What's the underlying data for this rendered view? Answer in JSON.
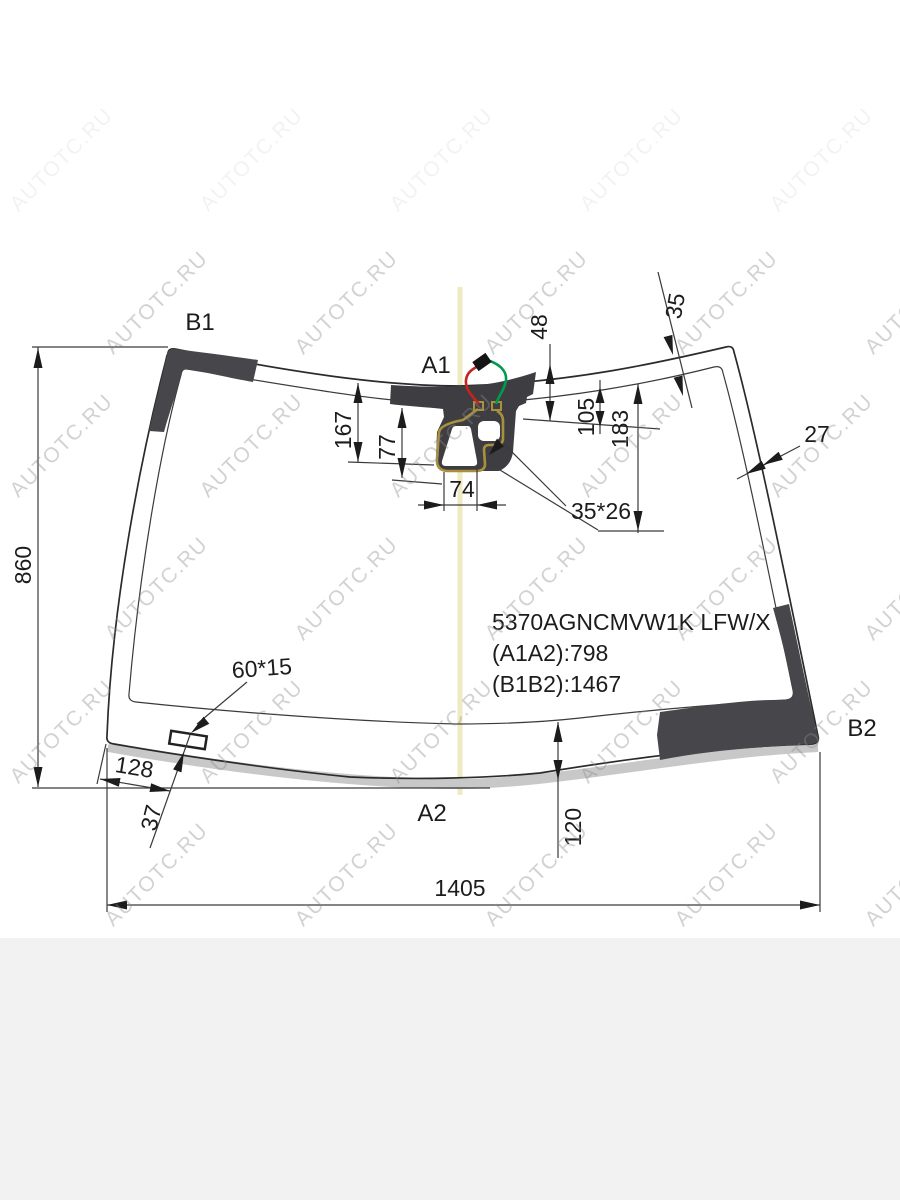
{
  "product": {
    "code": "5370AGNCMVW1K LFW/X",
    "a1a2": "(A1A2):798",
    "b1b2": "(B1B2):1467"
  },
  "labels": {
    "b1": "B1",
    "a1": "A1",
    "a2": "A2",
    "b2": "B2"
  },
  "dimensions": {
    "height": "860",
    "width": "1405",
    "d48": "48",
    "d35": "35",
    "d27": "27",
    "d167": "167",
    "d77": "77",
    "d74": "74",
    "d105": "105",
    "d183": "183",
    "d35x26": "35*26",
    "d60x15": "60*15",
    "d128": "128",
    "d37": "37",
    "d120": "120"
  },
  "watermark": {
    "text": "AUTOTC.RU"
  },
  "colors": {
    "band_dark": "#47474b",
    "housing_dark": "#3e3e42",
    "molding_gray": "#c8c8c8",
    "wire_red": "#c5231f",
    "wire_green": "#009a4e",
    "bracket_gold": "#a8903d",
    "centerline_yellow": "#eeeac2",
    "footer_gray": "#f2f2f2"
  }
}
